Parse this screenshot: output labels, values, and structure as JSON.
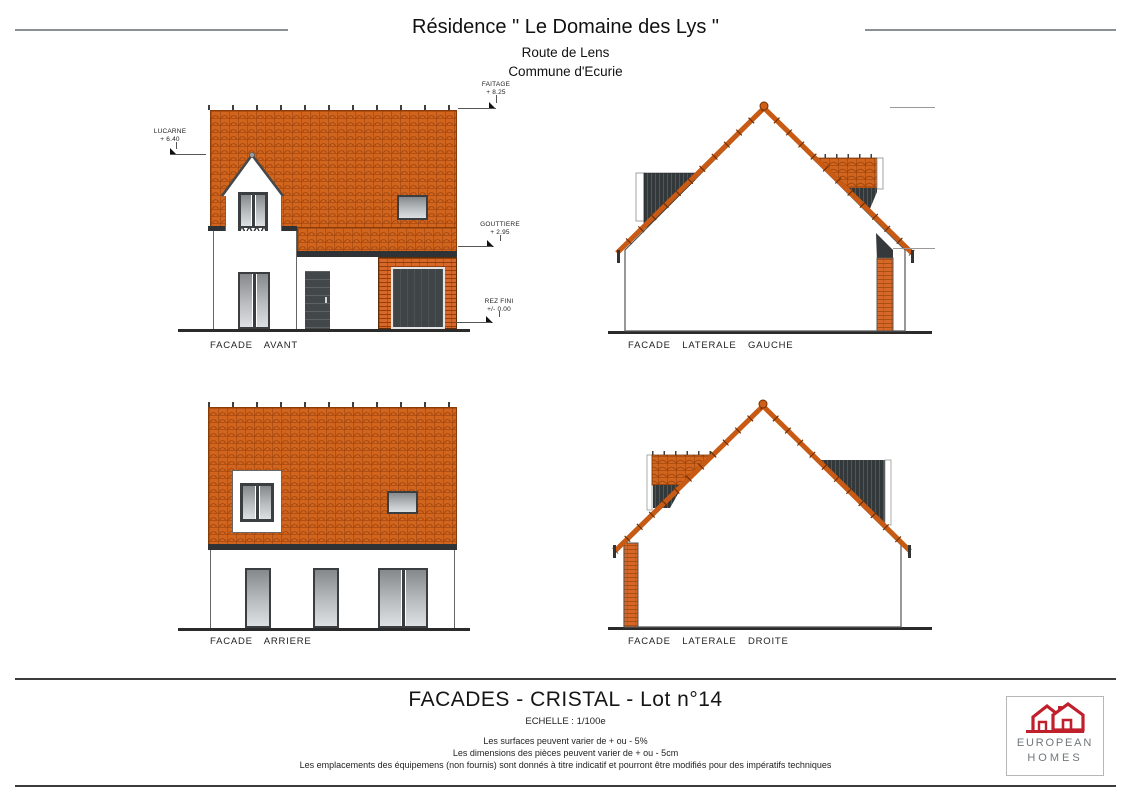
{
  "header": {
    "title": "Résidence \" Le Domaine des Lys \"",
    "address": "Route de Lens",
    "commune": "Commune d'Ecurie"
  },
  "annotations": {
    "faitage": {
      "label": "FAITAGE",
      "value": "+ 8.25"
    },
    "lucarne": {
      "label": "LUCARNE",
      "value": "+ 6.40"
    },
    "gouttiere": {
      "label": "GOUTTIERE",
      "value": "+ 2.95"
    },
    "rez_fini": {
      "label": "REZ FINI",
      "value": "+/- 0.00"
    }
  },
  "captions": {
    "avant": "FACADE AVANT",
    "laterale_gauche": "FACADE LATERALE GAUCHE",
    "arriere": "FACADE ARRIERE",
    "laterale_droite": "FACADE LATERALE DROITE"
  },
  "title_block": {
    "title": "FACADES - CRISTAL - Lot n°14",
    "scale": "ECHELLE : 1/100e",
    "notes": [
      "Les surfaces peuvent varier de + ou - 5%",
      "Les dimensions des pièces peuvent varier de + ou - 5cm",
      "Les emplacements des équipemens (non fournis) sont donnés à titre indicatif et pourront être modifiés pour des impératifs techniques"
    ]
  },
  "logo": {
    "line1": "EUROPEAN",
    "line2": "HOMES"
  },
  "colors": {
    "roof_tile": "#d2651e",
    "brick": "#d8682a",
    "cladding": "#35393b",
    "logo_red": "#c0202c",
    "logo_text": "#71777b"
  }
}
